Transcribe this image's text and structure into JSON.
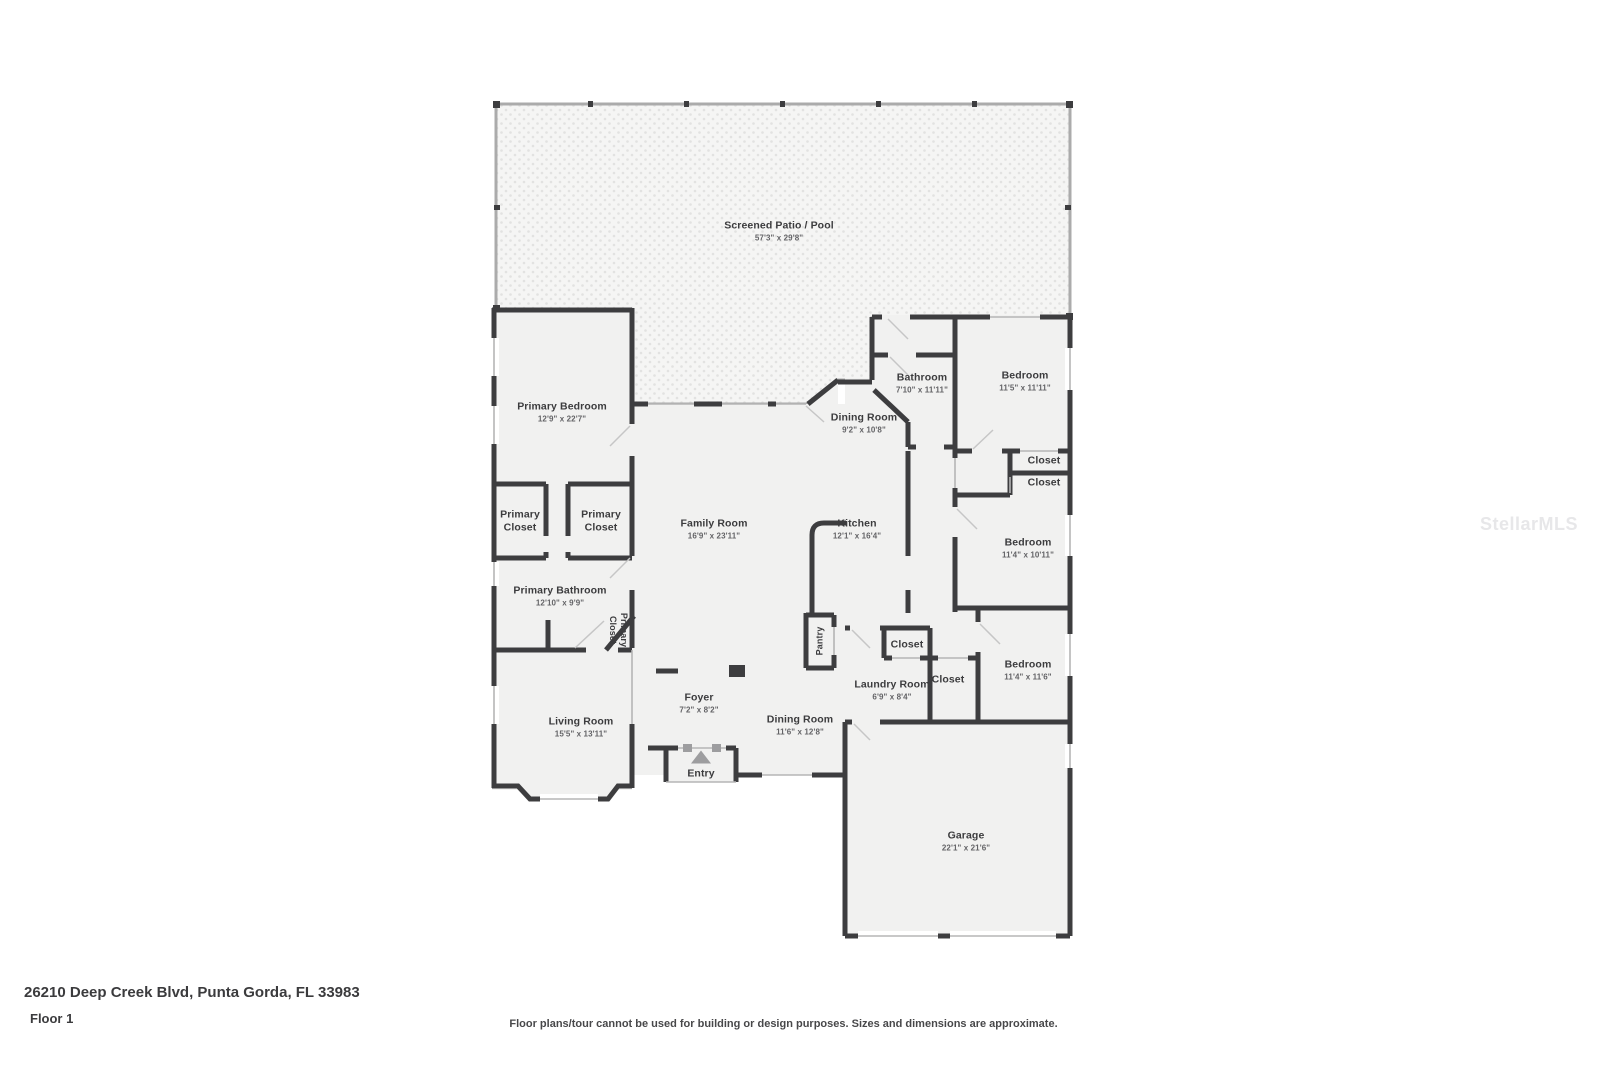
{
  "meta": {
    "address": "26210 Deep Creek Blvd, Punta Gorda, FL 33983",
    "floor": "Floor 1",
    "disclaimer": "Floor plans/tour cannot be used for building or design purposes. Sizes and dimensions are approximate.",
    "watermark": "StellarMLS"
  },
  "colors": {
    "wall": "#3d3d3f",
    "room_fill": "#f1f1f0",
    "patio_fill": "#f5f5f4",
    "patio_dot": "#e2e2e1",
    "thin_line": "#b5b5b5",
    "entry_arrow": "#9d9d9f"
  },
  "rooms": {
    "patio": {
      "name": "Screened Patio / Pool",
      "dims": "57'3\" x 29'8\""
    },
    "primary_bedroom": {
      "name": "Primary Bedroom",
      "dims": "12'9\" x 22'7\""
    },
    "bathroom": {
      "name": "Bathroom",
      "dims": "7'10\" x 11'11\""
    },
    "bedroom_top": {
      "name": "Bedroom",
      "dims": "11'5\" x 11'11\""
    },
    "dining_top": {
      "name": "Dining Room",
      "dims": "9'2\" x 10'8\""
    },
    "closet_a": {
      "name": "Closet"
    },
    "closet_b": {
      "name": "Closet"
    },
    "primary_closet_a": {
      "name": "Primary Closet"
    },
    "primary_closet_b": {
      "name": "Primary Closet"
    },
    "family_room": {
      "name": "Family Room",
      "dims": "16'9\" x 23'11\""
    },
    "kitchen": {
      "name": "Kitchen",
      "dims": "12'1\" x 16'4\""
    },
    "bedroom_mid": {
      "name": "Bedroom",
      "dims": "11'4\" x 10'11\""
    },
    "primary_bathroom": {
      "name": "Primary Bathroom",
      "dims": "12'10\" x 9'9\""
    },
    "primary_closet_c": {
      "name": "Primary Closet"
    },
    "pantry": {
      "name": "Pantry"
    },
    "closet_c": {
      "name": "Closet"
    },
    "closet_d": {
      "name": "Closet"
    },
    "bedroom_bottom": {
      "name": "Bedroom",
      "dims": "11'4\" x 11'6\""
    },
    "laundry": {
      "name": "Laundry Room",
      "dims": "6'9\" x 8'4\""
    },
    "foyer": {
      "name": "Foyer",
      "dims": "7'2\" x 8'2\""
    },
    "living_room": {
      "name": "Living Room",
      "dims": "15'5\" x 13'11\""
    },
    "dining_main": {
      "name": "Dining Room",
      "dims": "11'6\" x 12'8\""
    },
    "garage": {
      "name": "Garage",
      "dims": "22'1\" x 21'6\""
    },
    "entry": {
      "name": "Entry"
    }
  }
}
